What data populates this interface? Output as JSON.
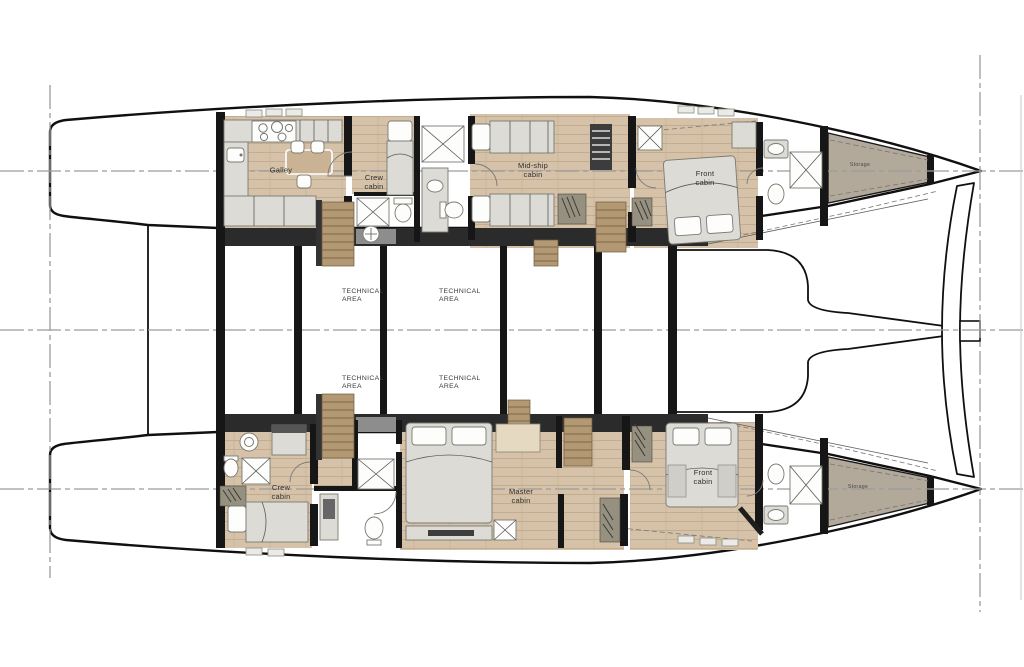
{
  "rooms": {
    "port": {
      "galley": "Galley",
      "crew": "Crew cabin",
      "midship": "Mid-ship cabin",
      "front": "Front cabin",
      "storage": "Storage"
    },
    "technical": [
      "TECHNICAL AREA",
      "TECHNICAL AREA",
      "TECHNICAL AREA",
      "TECHNICAL AREA"
    ],
    "starboard": {
      "crew": "Crew cabin",
      "master": "Master cabin",
      "front": "Front cabin",
      "storage": "Storage"
    }
  },
  "colors": {
    "wood": "#d5c2a8",
    "wood_grain": "#c2ad91",
    "furniture": "#dcdbd5",
    "furniture_edge": "#7a7a74",
    "wall": "#161616",
    "band": "#2b2b2b",
    "storage_fill": "#b2a99b",
    "stairs_wood": "#b29873",
    "refline": "#9c9c9c",
    "outline": "#101010",
    "label_text": "#2f2f2f"
  }
}
